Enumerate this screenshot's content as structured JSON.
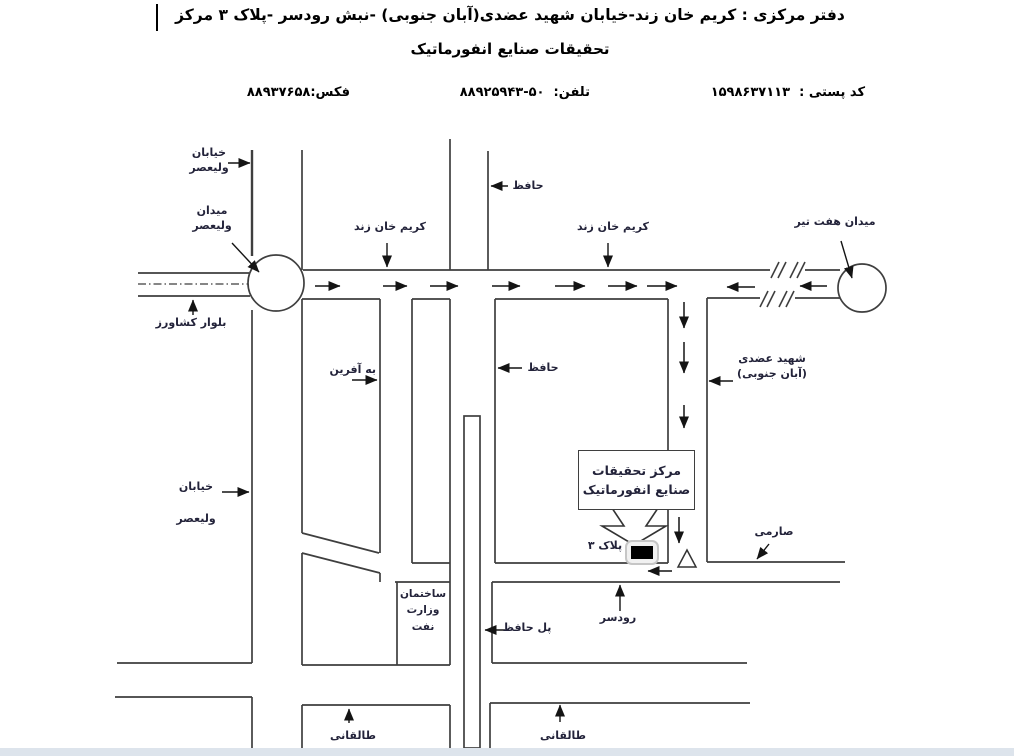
{
  "theme": {
    "line": "#3f3f3f",
    "arrow": "#141414",
    "label": "#23233a",
    "title": "#000000",
    "bottom_strip": "#dde4ec"
  },
  "header": {
    "title_line1": "دفتر مرکزی : کریم خان زند-خیابان شهید عضدی(آبان جنوبی) -نبش رودسر -پلاک ۳ مرکز",
    "title_line2": "تحقیقات صنایع انفورماتیک",
    "postal_label": "کد پستی :",
    "postal_code": "۱۵۹۸۶۳۷۱۱۳",
    "tel_label": "تلفن:",
    "tel_number": "۸۸۹۲۵۹۴۳-۵۰",
    "fax_label": "فکس:",
    "fax_number": "۸۸۹۳۷۶۵۸"
  },
  "map": {
    "labels": {
      "khiaban_valiasr_top": {
        "line1": "خیابان",
        "line2": "ولیعصر"
      },
      "meydan_valiasr": {
        "line1": "میدان",
        "line2": "ولیعصر"
      },
      "bolvar_keshavarz": {
        "text": "بلوار کشاورز"
      },
      "karim_khan_west": {
        "text": "کریم خان زند"
      },
      "karim_khan_east": {
        "text": "کریم خان زند"
      },
      "hafez_north": {
        "text": "حافظ"
      },
      "hafez_mid": {
        "text": "حافظ"
      },
      "meydan_haft_tir": {
        "text": "میدان هفت تیر"
      },
      "be_afarin": {
        "text": "به آفرین"
      },
      "shahid_azodi": {
        "line1": "شهید عضدی",
        "line2": "(آبان جنوبی)"
      },
      "khiaban_valiasr_mid": {
        "line1": "خیابان",
        "line2": "ولیعصر"
      },
      "research_center": {
        "line1": "مرکز تحقیقات",
        "line2": "صنایع انفورماتیک"
      },
      "pelak_3": {
        "text": "پلاک ۳"
      },
      "saremi": {
        "text": "صارمی"
      },
      "rudsar": {
        "text": "رودسر"
      },
      "pol_hafez": {
        "text": "پل حافظ"
      },
      "vezarat_naft": {
        "line1": "ساختمان",
        "line2": "وزارت",
        "line3": "نفت"
      },
      "taleghani_west": {
        "text": "طالقانی"
      },
      "taleghani_east": {
        "text": "طالقانی"
      }
    }
  }
}
